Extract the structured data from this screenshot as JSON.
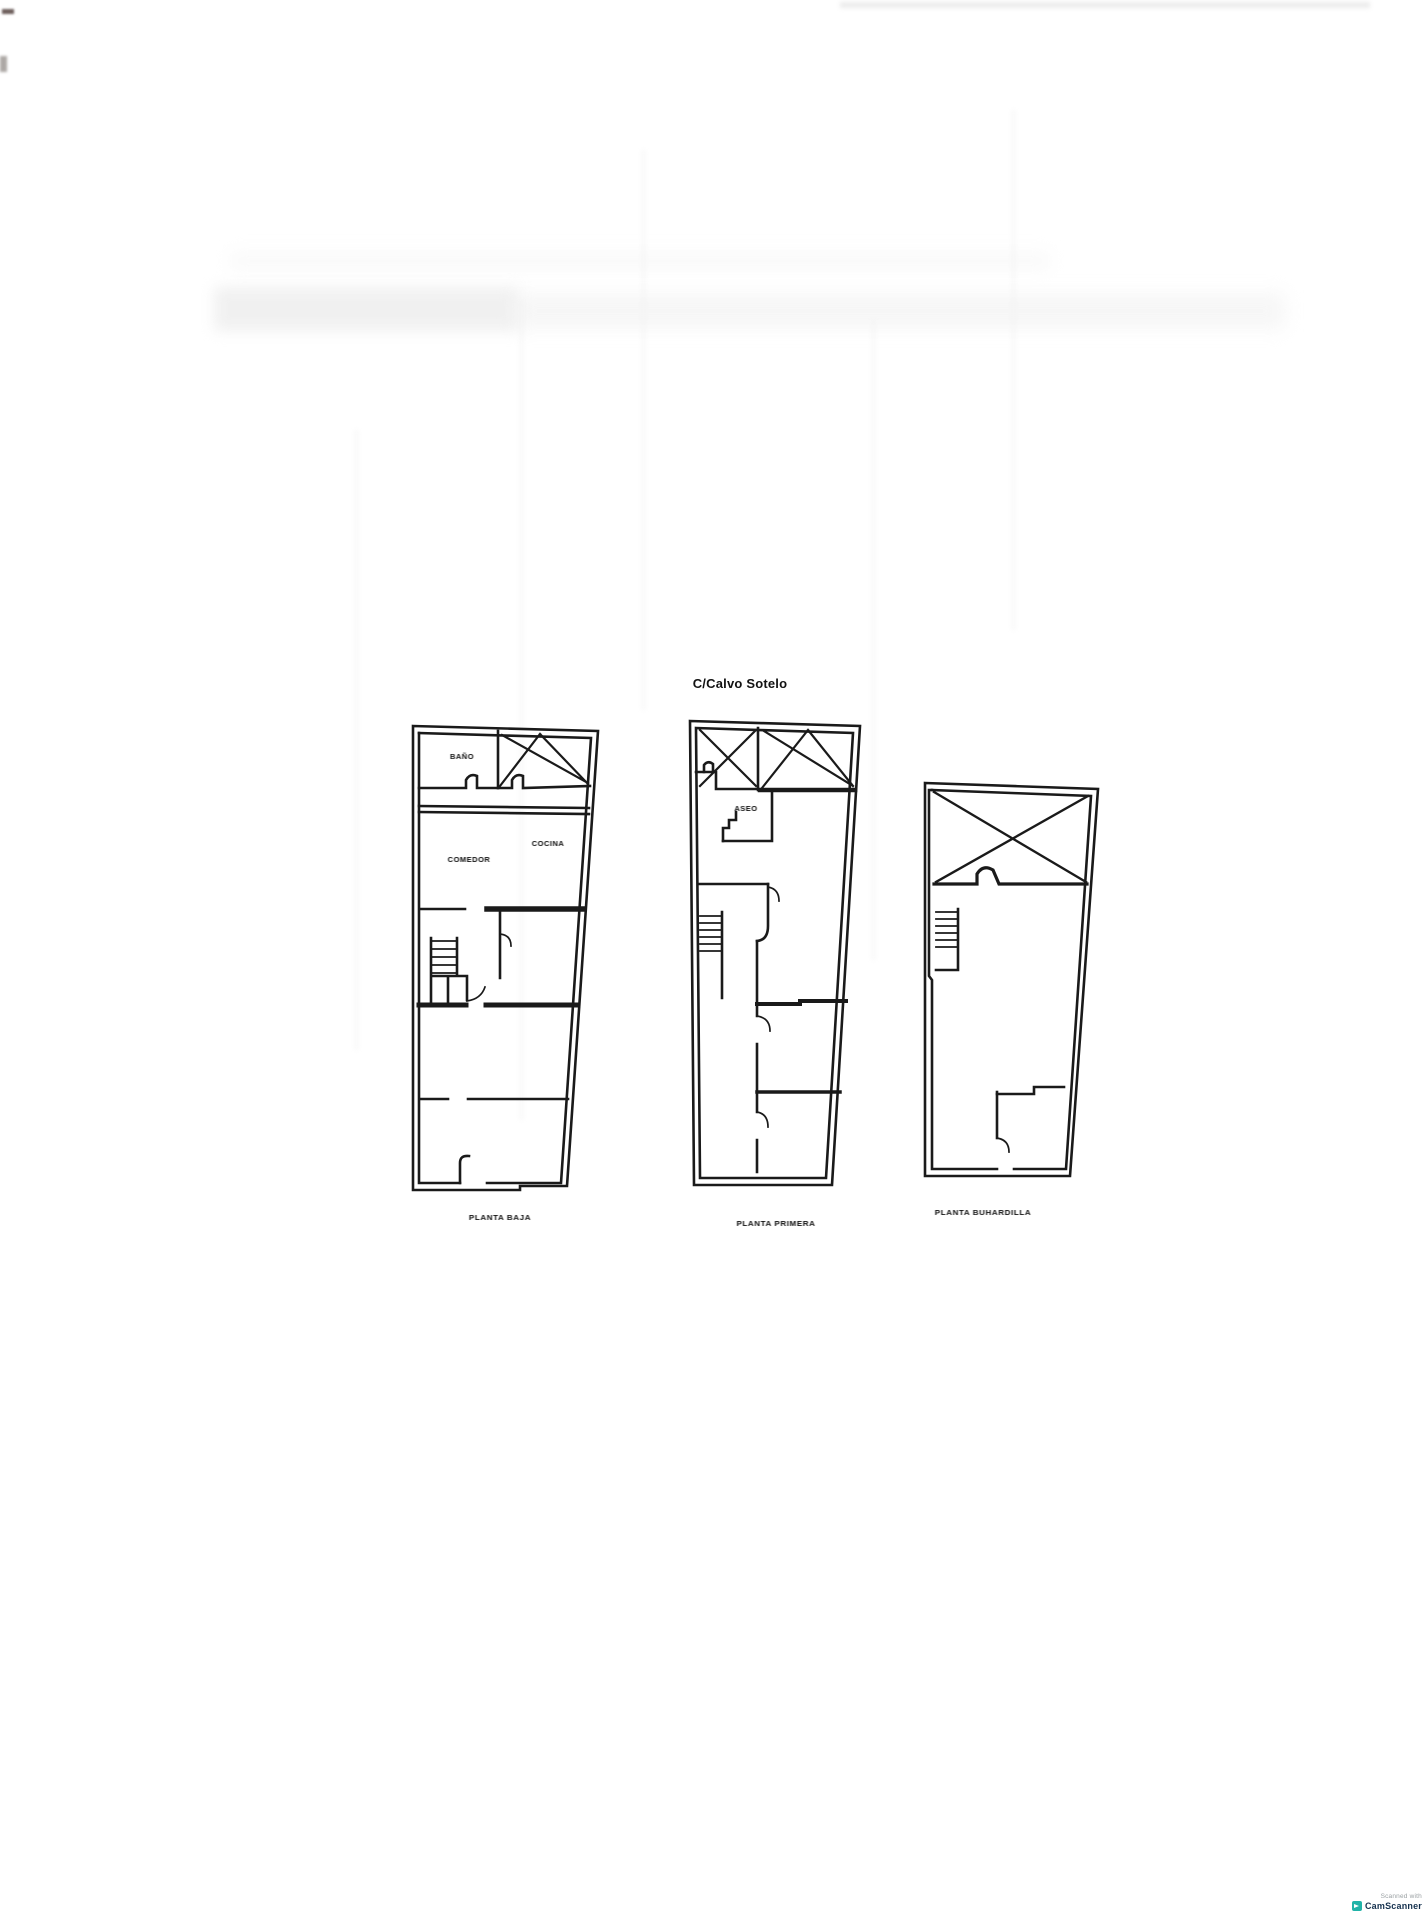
{
  "page": {
    "title": "C/Calvo Sotelo"
  },
  "plans": [
    {
      "caption": "PLANTA BAJA",
      "rooms": [
        {
          "label": "BAÑO"
        },
        {
          "label": "COCINA"
        },
        {
          "label": "COMEDOR"
        }
      ]
    },
    {
      "caption": "PLANTA PRIMERA",
      "rooms": [
        {
          "label": "ASEO"
        }
      ]
    },
    {
      "caption": "PLANTA BUHARDILLA",
      "rooms": []
    }
  ],
  "watermark": {
    "line1": "Scanned with",
    "line2": "CamScanner"
  },
  "colors": {
    "ink": "#1a1a1a",
    "paper": "#ffffff",
    "watermark_logo": "#21b3a8",
    "watermark_text": "#16324f"
  }
}
